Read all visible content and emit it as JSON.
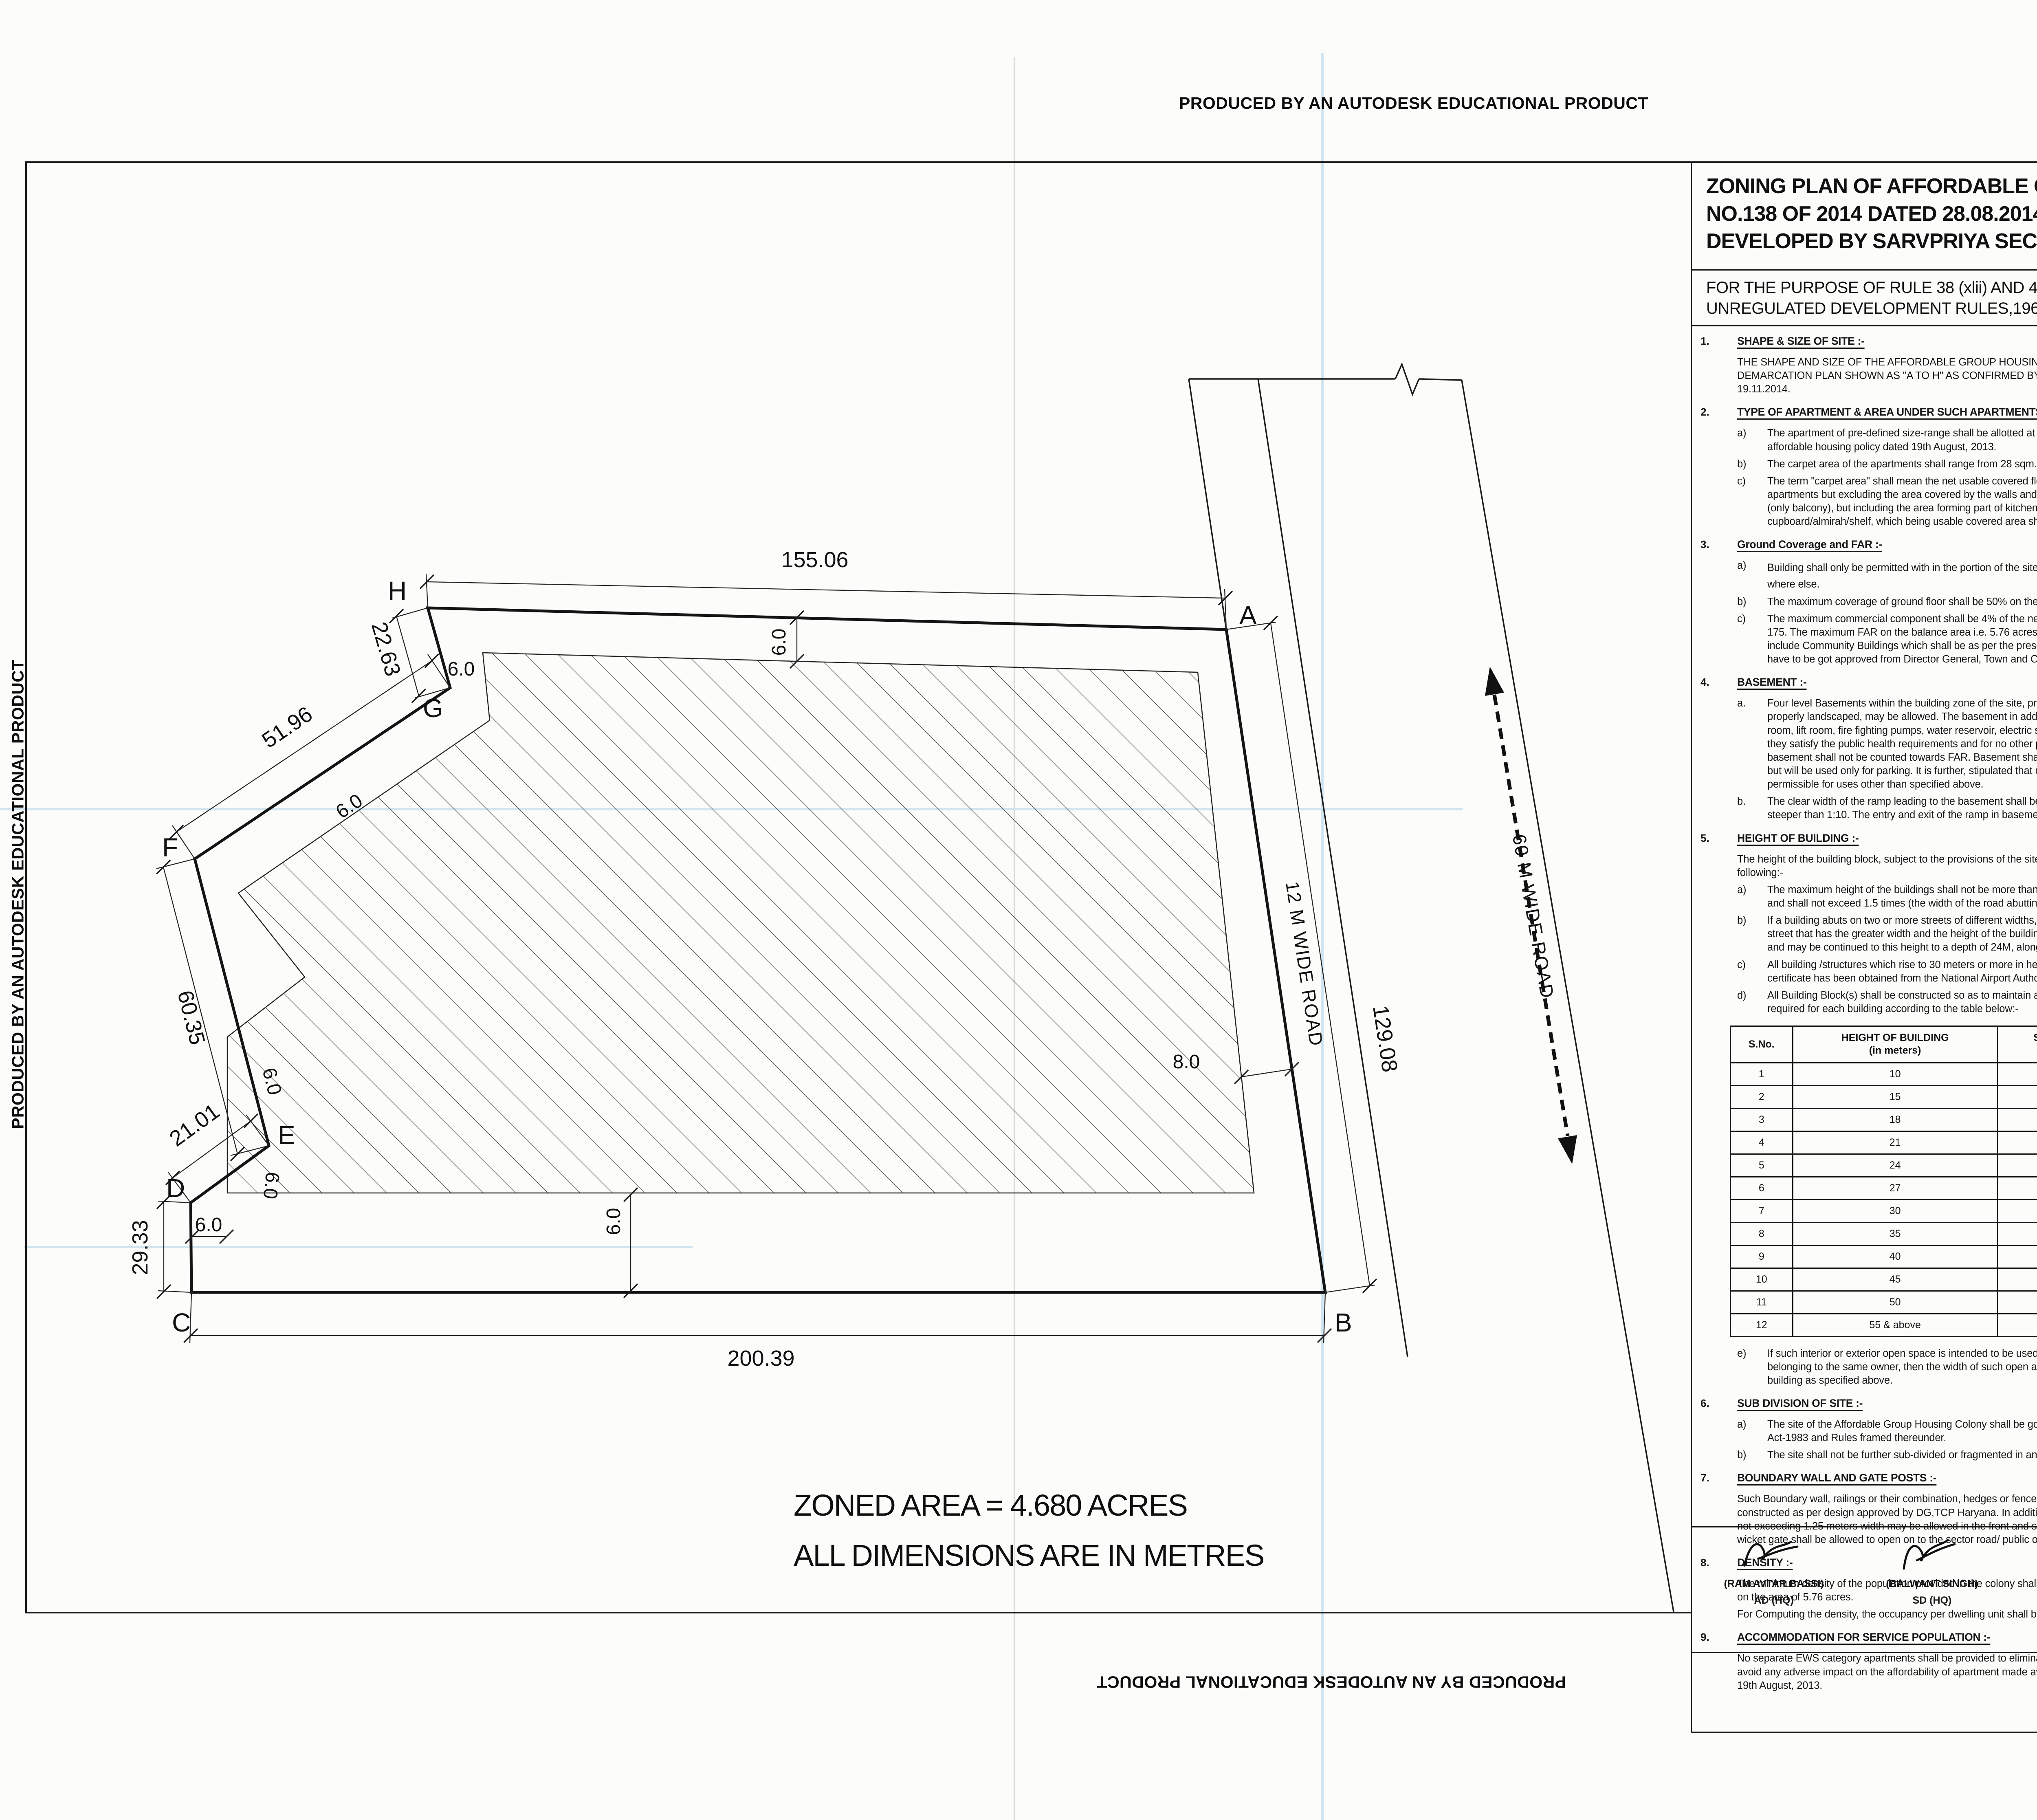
{
  "artifacts": {
    "autodesk_banner": "PRODUCED BY AN AUTODESK EDUCATIONAL PRODUCT"
  },
  "title_block": {
    "title": "ZONING PLAN OF AFFORDABLE GROUP HOUSING COLONY AREA MEASURING 6.00 ACRES (LICENCE NO.138 OF 2014 DATED 28.08.2014) IN SECTOR-71, GURGAON MANESAR URBAN COMPLEX, BEING DEVELOPED BY SARVPRIYA SECURITIES PVT. LTD.",
    "purpose": "FOR THE PURPOSE OF RULE 38 (xlii) AND 48 (2) OF THE PUNJAB SCHEDULED ROADS  AND CONTROLLED AREAS RESTRICTION OF UNREGULATED DEVELOPMENT RULES,1965."
  },
  "plan": {
    "zoned_area_note": "ZONED AREA = 4.680 ACRES",
    "dimensions_note": "ALL DIMENSIONS ARE IN METRES",
    "road12": "12 M WIDE ROAD",
    "road60": "60 M WIDE ROAD",
    "vertices": {
      "A": "A",
      "B": "B",
      "C": "C",
      "D": "D",
      "E": "E",
      "F": "F",
      "G": "G",
      "H": "H"
    },
    "dims": {
      "top": "155.06",
      "hg": "22.63",
      "gf": "51.96",
      "fe": "60.35",
      "ed": "21.01",
      "dc": "29.33",
      "cb": "200.39",
      "ba": "129.08",
      "setback6": "6.0",
      "setback8": "8.0"
    }
  },
  "height_table": {
    "headers": [
      "S.No.",
      "HEIGHT OF BUILDING\n(in meters)",
      "SET BACK / OPEN SPACE TO BE LEFT\nAROUND BUILDINGS. (in meters)"
    ],
    "rows": [
      [
        "1",
        "10",
        "3"
      ],
      [
        "2",
        "15",
        "5"
      ],
      [
        "3",
        "18",
        "6"
      ],
      [
        "4",
        "21",
        "7"
      ],
      [
        "5",
        "24",
        "8"
      ],
      [
        "6",
        "27",
        "9"
      ],
      [
        "7",
        "30",
        "10"
      ],
      [
        "8",
        "35",
        "11"
      ],
      [
        "9",
        "40",
        "12"
      ],
      [
        "10",
        "45",
        "13"
      ],
      [
        "11",
        "50",
        "14"
      ],
      [
        "12",
        "55 & above",
        "16"
      ]
    ]
  },
  "sections_left": [
    {
      "num": "1.",
      "heading": "SHAPE & SIZE OF SITE :-",
      "blocks": [
        {
          "text": "THE SHAPE AND SIZE OF THE AFFORDABLE GROUP HOUSING COLONY IS IN ACCORDANCE WITH THE DEMARCATION PLAN SHOWN AS \"A TO H\" AS CONFIRMED BY DTP, GURGAON vide Endst. No.4724 dated 19.11.2014."
        }
      ]
    },
    {
      "num": "2.",
      "heading": "TYPE OF APARTMENT & AREA UNDER SUCH APARTMENTS :-",
      "blocks": [
        {
          "label": "a)",
          "text": "The apartment of pre-defined size-range shall be allotted at a pre-defined rate to ensure provision of affordable housing policy dated 19th August, 2013."
        },
        {
          "label": "b)",
          "text": "The carpet area of the apartments shall  range from 28 sqm. to 60 sqm. in size."
        },
        {
          "label": "c)",
          "text": "The term \"carpet area\" shall mean the net usable covered floor area bound within the walls of the apartments but excluding the area covered by the walls and any  balcony which is approved free-of-FAR (only balcony), but including the area forming part of kitchen, toilet,bathroom,store and built-in cupboard/almirah/shelf, which being usable covered area shall form part of the carpet area."
        }
      ]
    },
    {
      "num": "3.",
      "heading": "Ground Coverage and FAR :-",
      "blocks": [
        {
          "label": "a)",
          "text": "Building shall only be permitted with in the portion of the site marked as",
          "hatch": true,
          "text2": "buildable  zone and no where else."
        },
        {
          "label": "b)",
          "text": "The maximum coverage of ground floor shall be 50%  on the area of  6.00 acres."
        },
        {
          "label": "c)",
          "text": "The maximum commercial component shall be 4% of the net planned area i.e. 0.240 acre with an FAR of 175. The maximum FAR on the balance area i.e. 5.76 acres shall not exceed 225. However it shall not include Community Buildings which shall be as per the prescribed norms the Building Plans of which shall have to be got approved from Director General, Town and Country Planning, Haryana."
        }
      ]
    },
    {
      "num": "4.",
      "heading": "BASEMENT :-",
      "blocks": [
        {
          "label": "a.",
          "text": "Four level Basements within the building zone of the site, provided, it is flushed with the ground and is properly landscaped, may be allowed. The basement in addition to parking could be utilized for generator room, lift room, fire fighting pumps, water reservoir, electric sub- station, air conditioning plants and toilets, if they satisfy the public health requirements and for no other purposes. Area under stilts (only for parking) and basement shall not be counted towards FAR. Basement shall not be used for storage/commercial purposes but will be used only for parking. It is further, stipulated that no other partitions of basement will be permissible for uses other than specified above."
        },
        {
          "label": "b.",
          "text": "The clear width of the ramp leading to the basement shall be 4.00 meters with an adequate slope not steeper than 1:10. The entry and exit of the ramp in basement shall be separate preferably at opposite ends"
        }
      ]
    },
    {
      "num": "5.",
      "heading": "HEIGHT OF BUILDING :-",
      "blocks": [
        {
          "text": "The height of the building block, subject to the provisions of the site coverage and FAR, shall be governed by the following:-"
        },
        {
          "label": "a)",
          "text": "The maximum height of the buildings shall not be more than as allowed by National Airport Authority of India and shall not exceed 1.5 times (the width of the road abutting) plus the front  open space."
        },
        {
          "label": "b)",
          "text": "If a building abuts on two or more streets of different widths, the buildings shall be deemed to face  upon the street that has the greater width and the height of the buildings shall be regulated by the width of that street and may be continued to this height to a depth of 24M, along the narrow street."
        },
        {
          "label": "c)",
          "text": "All building /structures which rise to 30 meters or more in height shall be constructed only if no objection certificate has been obtained from the National Airport Authority of India."
        },
        {
          "label": "d)",
          "text": "All Building Block(s) shall be constructed so as to maintain an interse distance not less then the set back required for each building according to the table below:-"
        },
        {
          "table": true
        },
        {
          "label": "e)",
          "text": "If such interior or exterior open space is intended to be used for the benefit of more than one building belonging to the same owner, then the width of such open air space  shall be the one specified for the tallest building as specified above."
        }
      ]
    },
    {
      "num": "6.",
      "heading": "SUB DIVISION OF SITE :-",
      "blocks": [
        {
          "label": "a)",
          "text": "The site of the Affordable Group Housing Colony shall be governed by the Haryana Apartment Ownership Act-1983 and Rules framed thereunder."
        },
        {
          "label": "b)",
          "text": "The site shall not be further sub-divided or fragmented in any manner, whatsoever."
        }
      ]
    },
    {
      "num": "7.",
      "heading": "BOUNDARY WALL AND GATE POSTS :-",
      "blocks": [
        {
          "text": "Such Boundary wall, railings or their combination, hedges or fences along with gates and gate posts shall be constructed as per design approved by DG,TCP Haryana. In addition to the gate/gates an additional wicket gate not exceeding 1.25 meters width may be allowed in the front and side boundary wall provided that no main gate or wicket gate shall be allowed to open on to the sector road/ public open space."
        }
      ]
    },
    {
      "num": "8.",
      "heading": "DENSITY :-",
      "blocks": [
        {
          "text": "The minimum density of the population provided in the colony shall be 850 PPA and the maximum shall be 900 PPA on the area of  5.76 acres."
        },
        {
          "text": "For Computing the density, the occupancy per dwelling unit shall be taken as five persons."
        }
      ]
    },
    {
      "num": "9.",
      "heading": "ACCOMMODATION FOR SERVICE POPULATION  :-",
      "blocks": [
        {
          "text": "No separate EWS category apartments shall be provided to eliminate any cross subsidy component and thus to avoid any adverse impact on the affordability of apartment made available under affordable housing policy dated 19th August, 2013."
        }
      ]
    }
  ],
  "sections_right": [
    {
      "num": "10.",
      "heading": "PARKING :-",
      "blocks": [
        {
          "label": "a.",
          "text": "The parking space shall be provided at the rate of half equivalent car space ( ECS) for each dwelling unit."
        },
        {
          "label": "b.",
          "text": "Only one two-wheeler parking site shall be earmarked for each flat, which shall be allotted only to the flat-owners. The parking bay of two-wheelers shall be 0.8 x 2.5 m."
        },
        {
          "label": "c.",
          "text": "No car parking shall be allotted to any apartment owner in such projects."
        },
        {
          "label": "d.",
          "text": "The balance available parking space, if any, beyond the allocated two-wheeler parking sites, can be earmarked as free-visitor-car-parking space"
        },
        {
          "label": "e.",
          "text": "The area for parking per car shall be as under :-"
        },
        {
          "label": "a)",
          "text": "Basement.",
          "value": "35 sqm.",
          "indent": true
        },
        {
          "label": "b)",
          "text": "Stilts.",
          "value": "30 sqm.",
          "indent": true
        },
        {
          "label": "c)",
          "text": "Open.",
          "value": "25 sqm.",
          "indent": true
        }
      ]
    },
    {
      "num": "11.",
      "heading": "LIFTS AND RAMPS :-",
      "blocks": [
        {
          "label": "i.",
          "text": "In building having more than four storeys, lift with 100% standby generators alongwith automatic switchover is mandatory alongwith staircase of requisite width and number. At least one lift  with minimum size of 1.80 M X 3.00 M shall be provided."
        },
        {
          "label": "ii.",
          "text": "In building upto four storeys, if lifts with 100% standby generators  along with automatic switchover are not provided then ramps conforming to the requirement of clause D-3 of Annexure-D of Part 3 of National building Code-2005 shall be provided."
        }
      ]
    },
    {
      "num": "12.",
      "heading": "OPEN SPACES :-",
      "blocks": [
        {
          "text": "While all the open spaces including those between the blocks and wings of Buildings shall be developed, equipped and landscaped according to the plan approved by DG,TCP, Haryana. At least 15% of the net planned area shall be developed as organized open space i.e. tot lots and play ground."
        }
      ]
    },
    {
      "num": "13.",
      "heading": "APPROVAL OF BUILDING PLANS :-",
      "blocks": [
        {
          "text": "The building plans of the buildings to be constructed at site shall have to be got approved from the DG,TCP, Haryana (under section 8 (2) of the Punjab Scheduled Roads and Controlled Areas, Restriction of Unregulated Development Act No. 41 of 1963) before starting the construction."
        }
      ]
    },
    {
      "num": "14.",
      "heading": "BUILDING BYE- LAWS :-",
      "blocks": [
        {
          "text": "The construction of the building/buildings shall be governed by the building rules provided in part  VII of the Punjab Scheduled Roads and Controlled Areas, Restriction of Unregulated Development Rules, 1965 and Indian Standard Code No. 4963-1987 regarding provisions for Physically Handicapped Persons. The owner shall also follow the provisions of Section 46 of The Persons With Disabilities (Equal Opportunities, Protection of Rights and Full Participation) Act, 1995 which includes construction of ramps in public buildings, adaption of toilets for wheel chair user, Braille symbols and auditory signals in elevators or lifts and other relevant measures. On the points where such rules are silent and stipulate no condition or norm, the model building byelaw issued by the Indian Standard, and as given in the National Building Code of India shall be followed as may be approved by DG,TCP, Haryana."
        }
      ]
    },
    {
      "num": "15.",
      "heading": "PROVISION OF COMMUNITY BUILDINGS :-",
      "blocks": [
        {
          "text": "The coloniser shall be required to provide the following community sites in the project , which shall form part of the common areas and facilities as defined under the Haryana Apartment Ownership Act-1983."
        },
        {
          "label": "a.",
          "text": "One built-up community Hall of not less than 185.81 Sqm. area."
        },
        {
          "label": "b.",
          "text": "One built-up Anganwadi-cum-creche of not less than 185.81 Sqm. area."
        }
      ]
    },
    {
      "num": "16.",
      "heading": "APPROACH TO SITE :-",
      "blocks": [
        {
          "text": "The vehicular approach to the site and parking lots shall be planned and provided giving due consideration to the junctions off and the junctions with the surrounding road to the satisfaction of the DG,TCP, Haryana."
        }
      ]
    },
    {
      "num": "17.",
      "heading": "FIRE SAFETY MEASURES :",
      "blocks": [
        {
          "label": "a)",
          "text": "The owner will ensure the provision of proper fire safety measures in the multi storeyed buildings conforming to the provisions of Punjab Scheduled Roads and Controlled Areas, Restriction of Unregulated Development Rules, 1965 / National Building Code of India and the same should be got certified from the competent authority."
        },
        {
          "label": "b)",
          "text": "Electric Sub Station/generator room if provided should be on solid ground near DG/LT. Control panel on ground floor or in upper basement and it should be located on outer periphery of the building, the same should be got approved from the competent authority."
        },
        {
          "label": "c)",
          "text": "To ensure fire fighting scheme shall be got approved from the Director, Urban Local Bodies, Haryana or any person authorized by the Director, Urban Local Bodies, Haryana. These approval shall be obtained prior to starting the construction work at site."
        }
      ]
    },
    {
      "num": "18.",
      "heading": "SOLAR WATER HEATING SYSTEM :-",
      "blocks": [
        {
          "text": "The provision of solar water heating system shall be as per norms specified by HAREDA and shall be made operational in each building blocks (where hot water is required) before applying for an occupation certificate."
        }
      ]
    },
    {
      "num": "19.",
      "heading": "RAIN WATER HARVESTING SYSTEM :-",
      "blocks": [
        {
          "text": "That the rain water harvesting system shall be provided as per Central Ground Water Authority norms/Haryana Govt. notification as applicable."
        }
      ]
    },
    {
      "num": "20.",
      "blocks": [
        {
          "text": "The owner shall obtain the clearance/NOC as per the provisions of the Notification No. S.O. 1533 (E) Dated 14.09.2006 issued by Ministry of Environment and Forest, Government of India before starting the construction/ execution of development works at site."
        }
      ]
    },
    {
      "num": "21.",
      "blocks": [
        {
          "text": "That the applicant shall use only Compact Fluorescent Lamps fitting for internal lighting as well as Campus lighting."
        }
      ]
    },
    {
      "num": "22,",
      "blocks": [
        {
          "text": "That no separate zoning plan is approved for community site/sites earmarked within group housing scheme. The community building/buildings shall be constructed by the coloniser/owner as per provisions of the Haryana Development and Regulation of Urban Areas (Amendment and validation) Act No. 4 of 2012, failing which the said site shall vest with the Government."
        }
      ]
    },
    {
      "num": "23.",
      "blocks": [
        {
          "text": "The coloniser shall convey the \"Ultimate Power Load Requirement\" of the project to the concerned power utility, with a copy to the Director, within two months period from the date of grant of licence to enable provision of site in your land for Transformers/Switching Station/Electric Sub-Stations as  per the norms prescribed by the power utility at the time of approval of building plans of the projects."
        }
      ]
    }
  ],
  "drg": {
    "label": "DRG. No. DG,TCP",
    "number": "5021",
    "dated_label": "DATED",
    "date": "22-12-2014"
  },
  "signatures": [
    {
      "name": "(RAM AVTAR BASSI)",
      "role": "AD (HQ)"
    },
    {
      "name": "(BALWANT SINGH)",
      "role": "SD (HQ)"
    },
    {
      "name": "(SAVITA JINDAL)",
      "role": "ATP (HQ)"
    },
    {
      "name": "(KARAMVEER SINGH)",
      "role": "DTP (HQ)"
    },
    {
      "name": "(JITENDER SIHAG)",
      "role": "STP (E & V)"
    },
    {
      "name": "(J. S. REDHU)",
      "role": "CTP (HR)"
    },
    {
      "name": "(ANURAG RASTOGI, IAS)",
      "role": "DGTCP (HR)"
    }
  ]
}
